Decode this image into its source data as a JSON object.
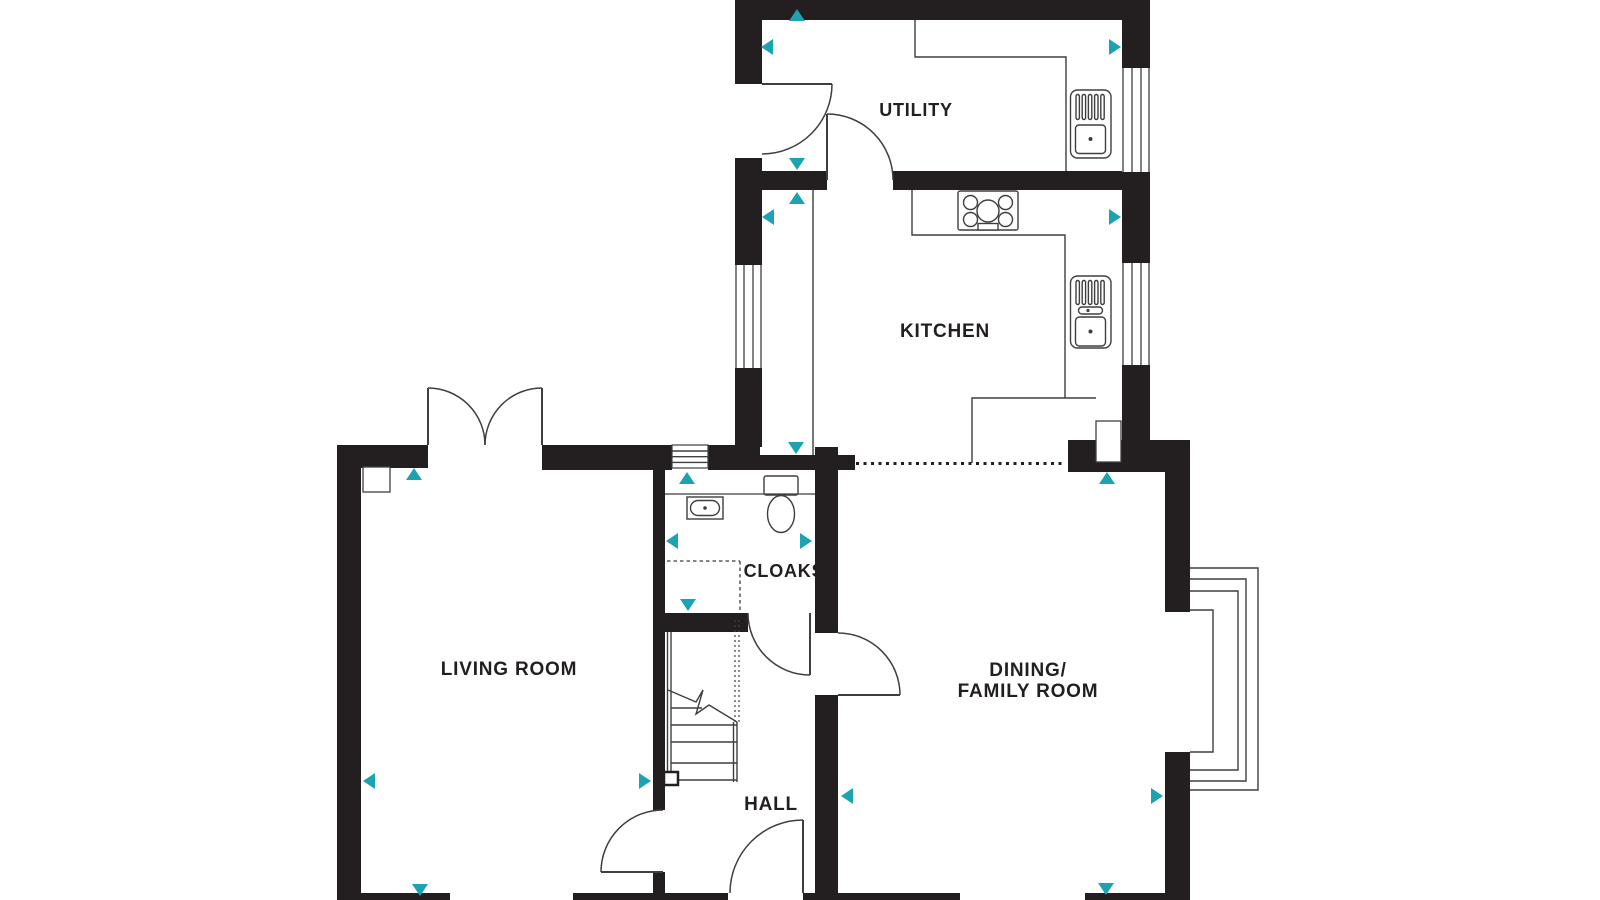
{
  "page": {
    "type": "floor-plan",
    "background": "#ffffff"
  },
  "colors": {
    "wall": "#231f20",
    "thin_line": "#3f3f3f",
    "accent_arrow": "#1ca3b2",
    "label_text": "#231f20"
  },
  "rooms": {
    "utility": {
      "label": "UTILITY"
    },
    "kitchen": {
      "label": "KITCHEN"
    },
    "cloaks": {
      "label": "CLOAKS"
    },
    "living": {
      "label": "LIVING ROOM"
    },
    "dining": {
      "line1": "DINING/",
      "line2": "FAMILY ROOM"
    },
    "hall": {
      "label": "HALL"
    }
  },
  "fixtures": {
    "utility_sink": "sink-drainer-unit",
    "kitchen_sink": "sink-drainer-unit",
    "hob": "four-burner-hob",
    "toilet": "wc-toilet",
    "basin": "hand-basin",
    "stairs": "staircase-up",
    "bay_window": "bay-window",
    "french_doors": "double-french-doors",
    "worktops": "kitchen-utility-worktops"
  },
  "annotations": {
    "measure_arrow": "teal-triangle-dimension-marker",
    "open_plan_divider": "dashed-line-kitchen-to-dining",
    "stair_headroom": "dashed-line-under-stairs"
  }
}
